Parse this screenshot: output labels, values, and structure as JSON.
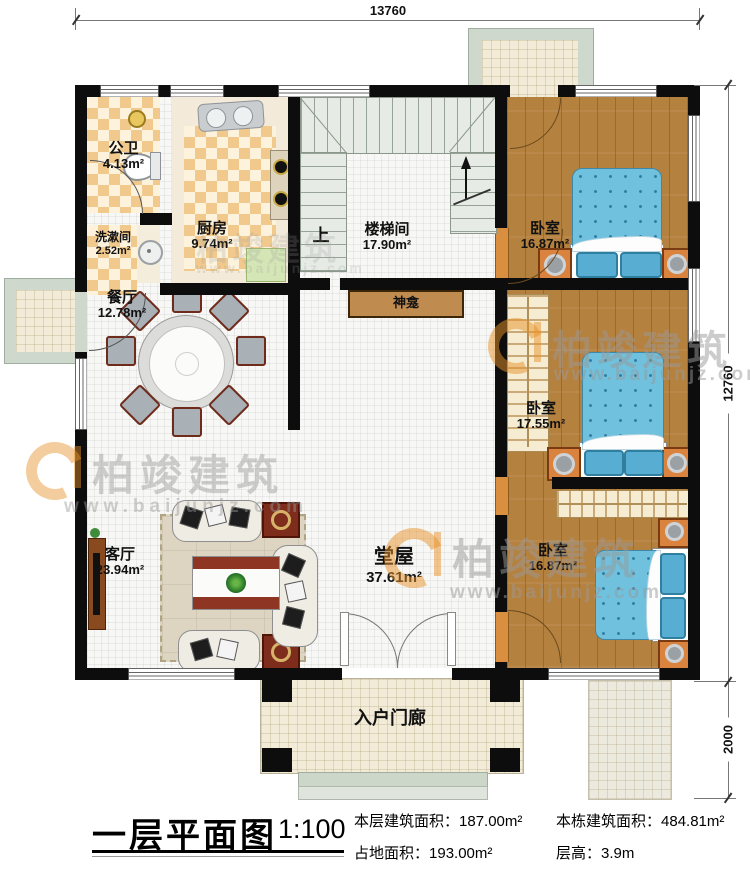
{
  "title_block": {
    "title": "一层平面图",
    "scale": "1:100",
    "stats": [
      {
        "label": "本层建筑面积：",
        "value": "187.00m²"
      },
      {
        "label": "本栋建筑面积：",
        "value": "484.81m²"
      },
      {
        "label": "占地面积：",
        "value": "193.00m²"
      },
      {
        "label": "层高：",
        "value": "3.9m"
      }
    ]
  },
  "dimensions": {
    "top": "13760",
    "right_main": "12760",
    "right_porch": "2000"
  },
  "rooms": {
    "public_bath": {
      "name": "公卫",
      "area": "4.13m²"
    },
    "washroom": {
      "name": "洗漱间",
      "area": "2.52m²"
    },
    "kitchen": {
      "name": "厨房",
      "area": "9.74m²"
    },
    "stairwell": {
      "name": "楼梯间",
      "area": "17.90m²"
    },
    "dining": {
      "name": "餐厅",
      "area": "12.78m²"
    },
    "bedroom_top": {
      "name": "卧室",
      "area": "16.87m²"
    },
    "bedroom_mid": {
      "name": "卧室",
      "area": "17.55m²"
    },
    "bedroom_bottom": {
      "name": "卧室",
      "area": "16.87m²"
    },
    "living": {
      "name": "客厅",
      "area": "23.94m²"
    },
    "hall": {
      "name": "堂屋",
      "area": "37.61m²"
    },
    "entry_porch": {
      "name": "入户门廊"
    }
  },
  "annotations": {
    "up": "上",
    "shrine": "神龛"
  },
  "watermark": {
    "brand": "柏竣建筑",
    "url": "www.baijunjz.com"
  },
  "colors": {
    "wall": "#0d0d0d",
    "wood_floor": "#b5813f",
    "tile_accent": "#f1c98c",
    "bed_blue": "#6fc1de",
    "nightstand_orange": "#d9833f",
    "porch_green": "#cfd8cd",
    "watermark_orange": "#e8922a",
    "watermark_grey": "#9a9a9a"
  }
}
